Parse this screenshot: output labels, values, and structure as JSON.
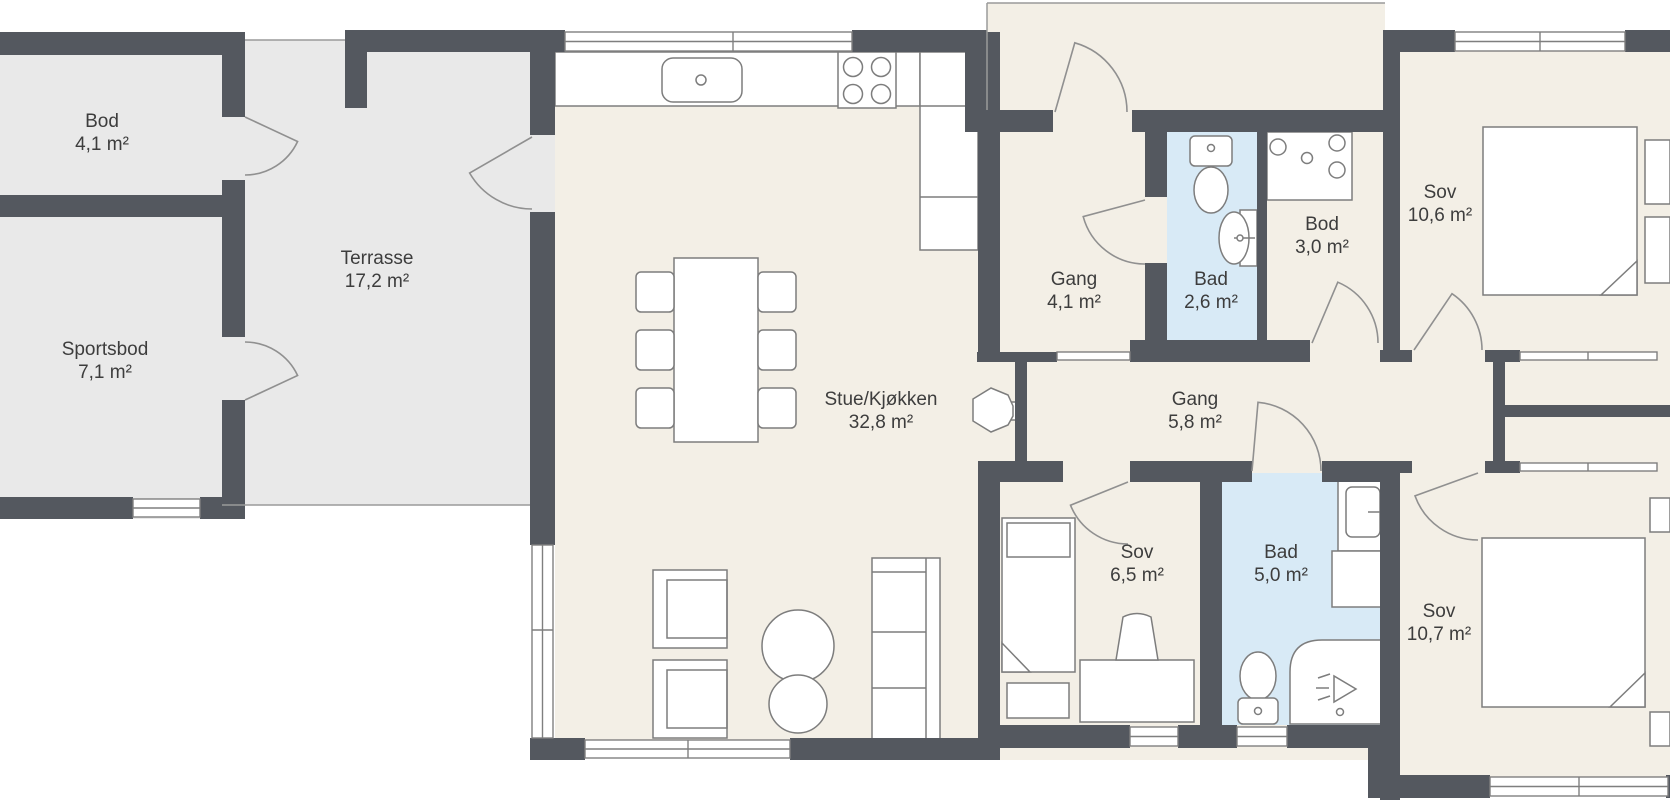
{
  "colors": {
    "wall": "#54585f",
    "floor": "#f3efe6",
    "outdoor": "#e9e9e9",
    "bath": "#d8eaf6",
    "furn": "#7d7d7d",
    "label": "#3d3d3d"
  },
  "rooms": [
    {
      "id": "bod-storage",
      "name": "Bod",
      "area": "4,1 m²"
    },
    {
      "id": "sportsbod",
      "name": "Sportsbod",
      "area": "7,1 m²"
    },
    {
      "id": "terrasse",
      "name": "Terrasse",
      "area": "17,2 m²"
    },
    {
      "id": "stue-kjokken",
      "name": "Stue/Kjøkken",
      "area": "32,8 m²"
    },
    {
      "id": "gang-entry",
      "name": "Gang",
      "area": "4,1 m²"
    },
    {
      "id": "bad-small",
      "name": "Bad",
      "area": "2,6 m²"
    },
    {
      "id": "bod-laundry",
      "name": "Bod",
      "area": "3,0 m²"
    },
    {
      "id": "sov-1",
      "name": "Sov",
      "area": "10,6 m²"
    },
    {
      "id": "gang-inner",
      "name": "Gang",
      "area": "5,8 m²"
    },
    {
      "id": "sov-2",
      "name": "Sov",
      "area": "6,5 m²"
    },
    {
      "id": "bad-large",
      "name": "Bad",
      "area": "5,0 m²"
    },
    {
      "id": "sov-3",
      "name": "Sov",
      "area": "10,7 m²"
    }
  ]
}
